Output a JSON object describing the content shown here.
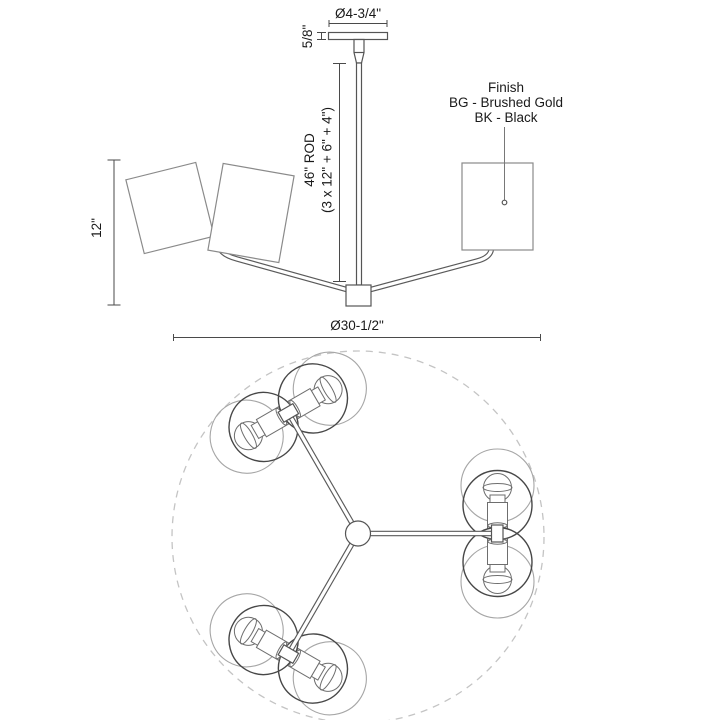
{
  "drawing": {
    "type": "lighting-fixture-specification",
    "views": [
      "side-elevation",
      "plan-view"
    ]
  },
  "side_view": {
    "labels": {
      "canopy_diameter": "Ø4-3/4\"",
      "canopy_height": "5/8\"",
      "rod_line1": "46\" ROD",
      "rod_line2": "(3 x 12\" + 6\" + 4\")",
      "fixture_height": "12\"",
      "fixture_diameter": "Ø30-1/2\""
    },
    "finish_note": {
      "title": "Finish",
      "options": [
        "BG - Brushed Gold",
        "BK - Black"
      ]
    }
  },
  "plan_view": {
    "arm_count": 3,
    "lamps_per_arm": 2
  },
  "colors": {
    "background": "#ffffff",
    "text": "#1a1a1a",
    "dimension_line": "#4a4a4a",
    "fixture_line": "#555555",
    "shade_line": "#8a8a8a",
    "globe_dark_line": "#474747",
    "globe_light_line": "#a6a6a6",
    "dashed_circle": "#c4c4c4"
  }
}
